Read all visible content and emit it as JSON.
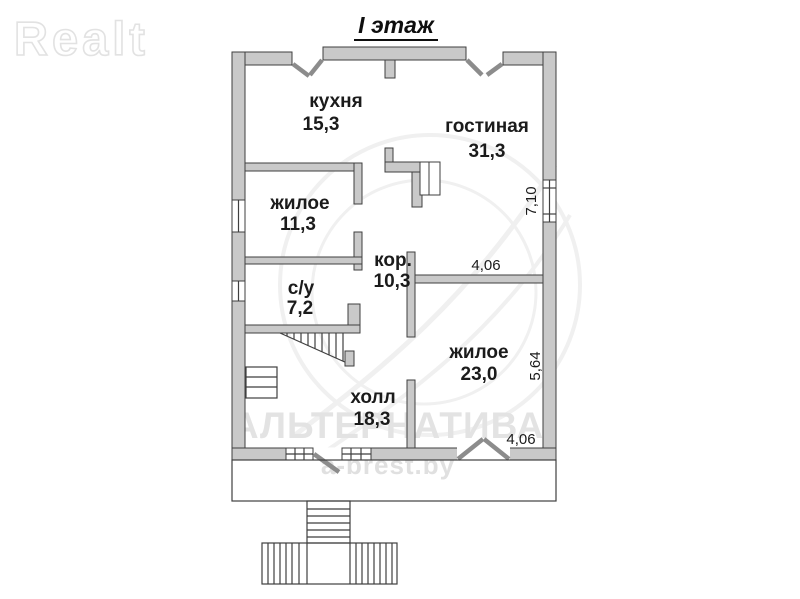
{
  "page": {
    "title": "I этаж",
    "logo": "Realt",
    "watermark_line1": "АЛЬТЕРНАТИВА",
    "watermark_line2": "a-brest.by"
  },
  "colors": {
    "wall_fill": "#c9c9c9",
    "wall_stroke": "#3f3f3f",
    "watermark_gray": "#e3e3e3",
    "label_black": "#1b1b1b"
  },
  "floorplan": {
    "floor_label": "I этаж",
    "rooms": [
      {
        "name": "кухня",
        "area": "15,3"
      },
      {
        "name": "гостиная",
        "area": "31,3"
      },
      {
        "name": "жилое",
        "area": "11,3"
      },
      {
        "name": "кор.",
        "area": "10,3"
      },
      {
        "name": "с/у",
        "area": "7,2"
      },
      {
        "name": "жилое",
        "area": "23,0"
      },
      {
        "name": "холл",
        "area": "18,3"
      }
    ],
    "dimensions": [
      {
        "value": "7,10",
        "orientation": "vertical",
        "location": "right-wall-upper"
      },
      {
        "value": "4,06",
        "orientation": "horizontal",
        "location": "living-bedroom-wall"
      },
      {
        "value": "5,64",
        "orientation": "vertical",
        "location": "right-wall-lower"
      },
      {
        "value": "4,06",
        "orientation": "horizontal",
        "location": "bottom-wall-window"
      }
    ]
  }
}
